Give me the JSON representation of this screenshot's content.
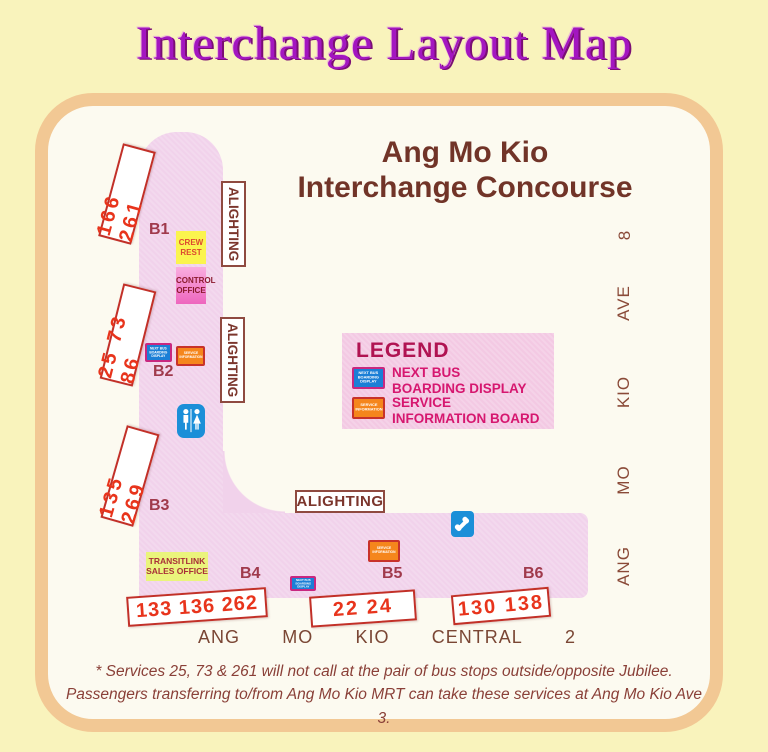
{
  "title": "Interchange Layout Map",
  "concourse": {
    "heading": [
      "Ang Mo Kio",
      "Interchange Concourse"
    ]
  },
  "alighting": "ALIGHTING",
  "berths": [
    {
      "id": "B1",
      "services": "166 261"
    },
    {
      "id": "B2",
      "services": "25 73 86"
    },
    {
      "id": "B3",
      "services": "135 269"
    },
    {
      "id": "B4",
      "services": "133 136 262"
    },
    {
      "id": "B5",
      "services": "22 24"
    },
    {
      "id": "B6",
      "services": "130 138"
    }
  ],
  "facilities": {
    "crew_rest": [
      "CREW",
      "REST"
    ],
    "control_office": [
      "CONTROL",
      "OFFICE"
    ],
    "transitlink": [
      "TRANSITLINK",
      "SALES OFFICE"
    ]
  },
  "icon_text": {
    "next_bus": [
      "NEXT BUS",
      "BOARDING",
      "DISPLAY"
    ],
    "service_info": [
      "SERVICE",
      "INFORMATION"
    ]
  },
  "legend": {
    "title": "LEGEND",
    "items": [
      {
        "label": [
          "NEXT BUS",
          "BOARDING DISPLAY"
        ]
      },
      {
        "label": [
          "SERVICE",
          "INFORMATION BOARD"
        ]
      }
    ]
  },
  "streets": {
    "right_vertical": [
      "8",
      "AVE",
      "KIO",
      "MO",
      "ANG"
    ],
    "bottom": [
      "ANG",
      "MO",
      "KIO",
      "CENTRAL",
      "2"
    ]
  },
  "footnote": [
    "* Services 25, 73 & 261 will not call at the pair of bus stops outside/opposite Jubilee.",
    "Passengers transferring to/from Ang Mo Kio MRT can take these services at Ang Mo Kio Ave 3."
  ],
  "colors": {
    "page_bg": "#F9F3BC",
    "card_border": "#F2C894",
    "card_bg": "#FCFAF0",
    "concourse_pink": "#F1D2EB",
    "legend_pink": "#F3C9E3",
    "stop_red": "#E8341C",
    "maroon": "#713428",
    "title_purple": "#A316C0",
    "display_blue": "#1B7FD6",
    "info_orange": "#F5861C",
    "picto_blue": "#1B8FD8"
  }
}
